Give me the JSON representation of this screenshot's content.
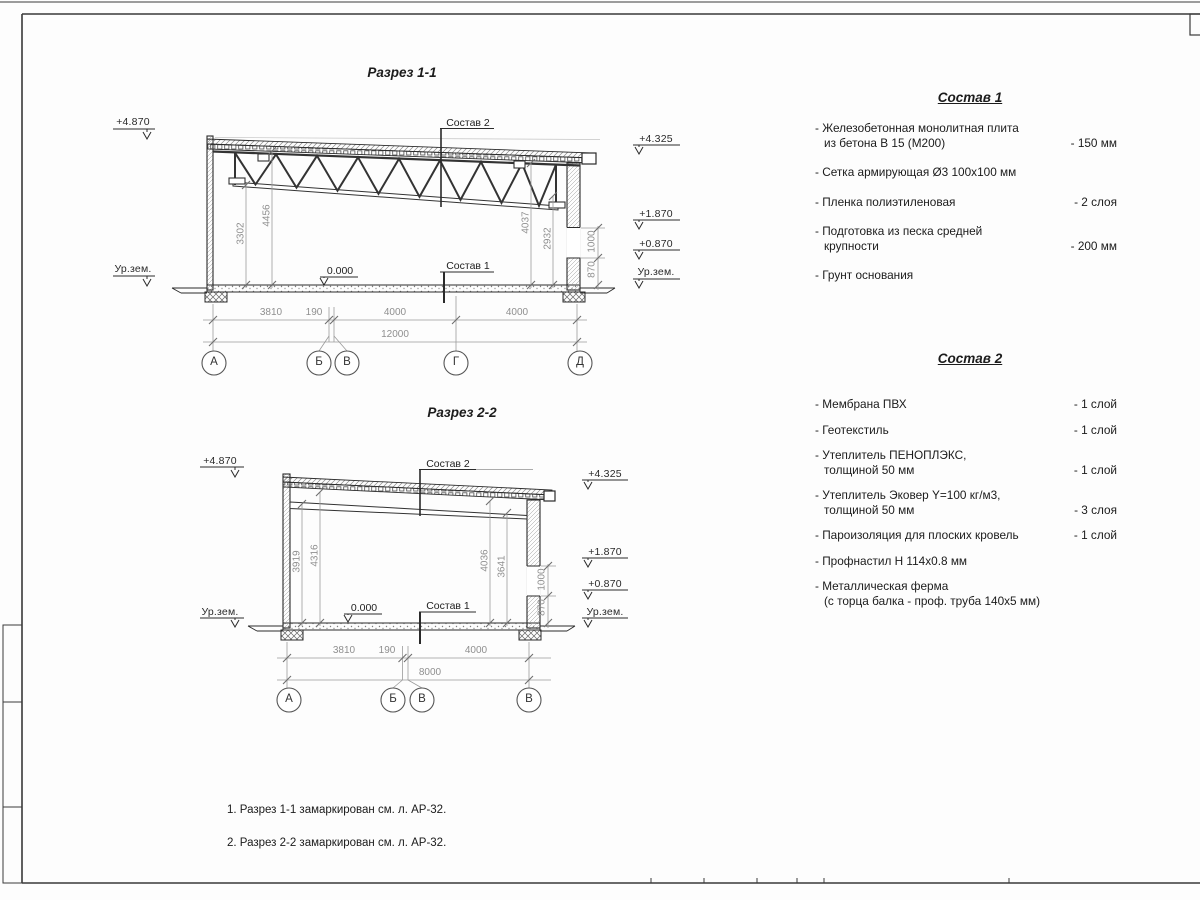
{
  "section1": {
    "title": "Разрез 1-1",
    "elev_left_top": "+4.870",
    "elev_left_ground": "Ур.зем.",
    "elev_right_top": "+4.325",
    "elev_right_mid1": "+1.870",
    "elev_right_mid2": "+0.870",
    "elev_right_ground": "Ур.зем.",
    "zero_mark": "0.000",
    "ref_roof": "Состав 2",
    "ref_floor": "Состав 1",
    "vdims": [
      "3302",
      "4456",
      "4037",
      "2932"
    ],
    "side_dims": [
      "1000",
      "870"
    ],
    "hdims": [
      "3810",
      "190",
      "4000",
      "4000"
    ],
    "total_dim": "12000",
    "axes": [
      "А",
      "Б",
      "В",
      "Г",
      "Д"
    ]
  },
  "section2": {
    "title": "Разрез 2-2",
    "elev_left_top": "+4.870",
    "elev_left_ground": "Ур.зем.",
    "elev_right_top": "+4.325",
    "elev_right_mid1": "+1.870",
    "elev_right_mid2": "+0.870",
    "elev_right_ground": "Ур.зем.",
    "zero_mark": "0.000",
    "ref_roof": "Состав 2",
    "ref_floor": "Состав 1",
    "vdims": [
      "3919",
      "4316",
      "4036",
      "3641"
    ],
    "side_dims": [
      "1000",
      "870"
    ],
    "hdims": [
      "3810",
      "190",
      "4000"
    ],
    "total_dim": "8000",
    "axes": [
      "А",
      "Б",
      "В",
      "В"
    ]
  },
  "sostav1": {
    "title": "Состав 1",
    "items": [
      {
        "name": "- Железобетонная  монолитная плита\nиз бетона В 15 (М200)",
        "value": "- 150 мм"
      },
      {
        "name": "- Сетка армирующая Ø3 100x100 мм",
        "value": ""
      },
      {
        "name": "- Пленка полиэтиленовая",
        "value": "-  2 слоя"
      },
      {
        "name": "- Подготовка из песка средней\nкрупности",
        "value": "- 200 мм"
      },
      {
        "name": "- Грунт основания",
        "value": ""
      }
    ]
  },
  "sostav2": {
    "title": "Состав 2",
    "items": [
      {
        "name": "- Мембрана ПВХ",
        "value": "- 1 слой"
      },
      {
        "name": "- Геотекстиль",
        "value": "- 1 слой"
      },
      {
        "name": "- Утеплитель ПЕНОПЛЭКС,\nтолщиной 50 мм",
        "value": "- 1 слой"
      },
      {
        "name": "- Утеплитель Эковер Y=100 кг/м3,\nтолщиной 50 мм",
        "value": "- 3 слоя"
      },
      {
        "name": "- Пароизоляция для плоских кровель",
        "value": "- 1 слой"
      },
      {
        "name": "- Профнастил Н 114x0.8 мм",
        "value": ""
      },
      {
        "name": "- Металлическая ферма\n(с торца балка - проф. труба 140x5 мм)",
        "value": ""
      }
    ]
  },
  "notes": {
    "line1": "1. Разрез 1-1 замаркирован см. л. АР-32.",
    "line2": "2. Разрез 2-2 замаркирован см. л. АР-32."
  }
}
